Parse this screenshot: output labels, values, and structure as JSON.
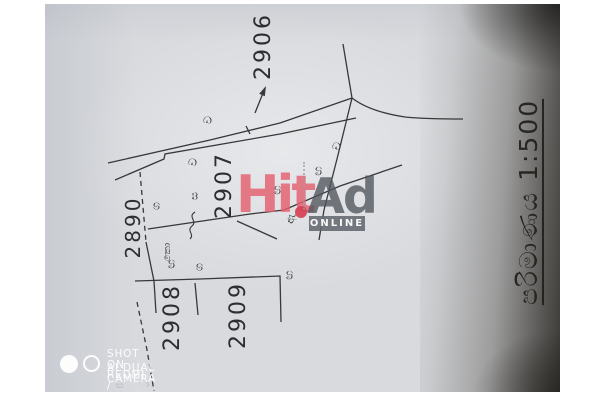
{
  "paper": {
    "color": "#d8dade",
    "margin_color": "#ffffff",
    "ink_color": "#38383a"
  },
  "plan": {
    "lot_numbers": {
      "top": "2906",
      "center": "2907",
      "left": "2890",
      "bottom_left": "2908",
      "bottom_center": "2909"
    },
    "scale_label": "පරිමාණය 1:500",
    "boundary_markers": [
      {
        "char": "ව"
      },
      {
        "char": "ව"
      },
      {
        "char": "ස"
      },
      {
        "char": "ග"
      },
      {
        "char": "කො"
      },
      {
        "char": "ඟ"
      },
      {
        "char": "ග"
      },
      {
        "char": "ඟ"
      },
      {
        "char": "ච"
      },
      {
        "char": "ඟ"
      },
      {
        "char": "ඟ"
      },
      {
        "char": "ඇ"
      }
    ],
    "pencil_marks": [
      {
        "char": "ඟ"
      },
      {
        "char": "ා"
      }
    ]
  },
  "watermarks": {
    "hitad": {
      "word1": "Hit",
      "word2": "Ad",
      "badge": "ONLINE",
      "word1_color": "#e45f6e",
      "word2_color": "#50545c",
      "badge_bg": "#646870"
    },
    "camera": {
      "line1": "SHOT ON REDMI /",
      "line2": "AI DUAL CAMERA",
      "color": "#ffffff"
    }
  }
}
